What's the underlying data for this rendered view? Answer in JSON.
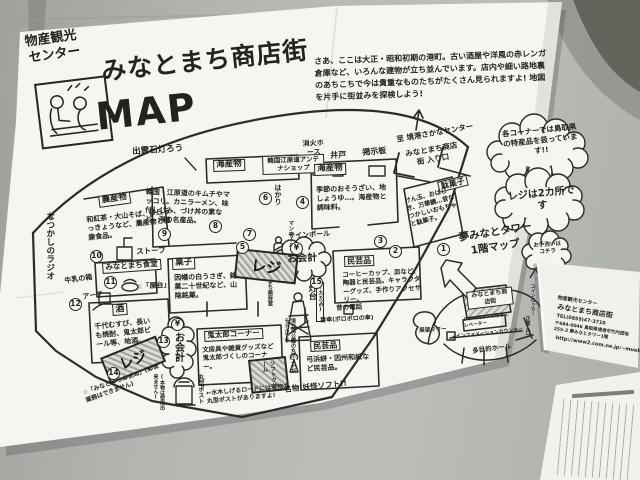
{
  "poster": {
    "header": {
      "org1": "物産観光",
      "org2": "センター",
      "title": "みなとまち商店街",
      "map_word": "MAP",
      "intro": "さあ、ここは大正・昭和初期の港町。古い酒屋や洋風の赤レンガ倉庫など、いろんな建物が立ち並んでいます。店内や細い路地裏のあちこちで今は貴重なものたちがたくさん見られますよ! 地図を片手に街並みを探検しよう!"
    },
    "bubbles": {
      "specialty": "各コーナーでは鳥取県の特産品を扱っています!!",
      "registers": "レジは2カ所です",
      "checkout": "お会計",
      "yen": "¥",
      "toilet": "お手洗いはコチラ"
    },
    "register_label": "レジ",
    "numbers": {
      "n1": "1",
      "n2": "2",
      "n3": "3",
      "n4": "4",
      "n5": "5",
      "n6": "6",
      "n7": "7",
      "n8": "8",
      "n9": "9",
      "n10": "10",
      "n11": "11",
      "n12": "12",
      "n13": "13",
      "n14": "14",
      "n15": "15"
    },
    "labels": {
      "izumo_lantern": "出雲石灯ろう",
      "fire_hose": "消火ホース",
      "well": "井戸",
      "notice_board": "掲示板",
      "to_fish_center": "至 境港さかなセンター",
      "entrance": "みなとまち商店街 入り口",
      "scale": "はかり",
      "manhole": "マンホール",
      "seafood1": "海産物",
      "korea_shop": "韓国江原道アンテナショップ",
      "korea_desc": "韓国・江原道のキムチやマッコリ。カニラーメン、味付しじみ、づけ丼の素など、海の名産品。",
      "seafood2": "海産物",
      "seafood2_desc": "季節のおそうざい、地しょうゆ…。海産物と調味料。",
      "dagashi": "駄菓子",
      "dagashi_desc": "けん玉、おはじき、万華鏡…昔なつかしいおもちゃと駄菓子。",
      "mingei1": "民芸品",
      "mingei1_desc": "コーヒーカップ、皿など、陶器と民芸品。キャラクターグッズ、手作りアクセサリー。",
      "kashi": "菓子",
      "kashi_desc": "因幡の白うさぎ、銘菓二十世紀など、山陰銘菓。",
      "nosan": "農産物",
      "nosan_desc": "和紅茶・大山そば、砂丘らっきょうなど、農産物と健康食品。",
      "radio": "なつかしのラジオ",
      "stove": "ストーブ",
      "shokudo": "みなとまち食堂",
      "yatai": "☆「屋台」",
      "milk_box": "牛乳の箱",
      "arch": "アーチ",
      "sake": "酒",
      "sake_desc": "千代むすび、長いも焼酎、鬼太郎ビール等、地酒。",
      "kitaro": "鬼太郎コーナー",
      "kitaro_desc": "文房具や雑貨グッズなど鬼太郎づくしのコーナー。",
      "softcream": "ソフトクリーム",
      "meibutsu": "名物!妖怪ソフト!!",
      "round_post": "丸型ポスト",
      "post_note": "(本物は使用出来ません)",
      "post_model": "境台場公園の丸ポストがモデルです",
      "mizuki_note": "←水木しげるロードには現物の丸型ポストがありますよ!",
      "post_office": "☆「みなとまち郵便局」(郵便業務はできません)",
      "mingei2": "民芸品",
      "mingei2_desc": "弓浜絣・因州和紙など民芸品。",
      "tatami": "(たたみ)",
      "old_phone": "昔の電話",
      "bangasa": "番傘(ボロボロの傘)",
      "lighthouse": "灯台",
      "sign_pole": "サインポール",
      "beauty_shop": "みなとまち美容室"
    },
    "tower": {
      "heading1": "夢みなとタワー",
      "heading2": "1階マップ",
      "tenbo": "展望タワー",
      "shotengai": "みなとまち商店街",
      "elevator": "タワーズカフェ行きエレベーター",
      "info": "←インフォメーションカウンター",
      "hall": "多目的ホール",
      "front_gate": "正面入口",
      "locker": "コインロッカー"
    },
    "contact": {
      "line1": "物産観光センター",
      "line2": "みなとまち商店街",
      "line3": "TEL(0859)47-3710",
      "line4": "〒684-0046 鳥取県境港市竹内団地255-3 夢みなとタワー1階",
      "line5": "http://www2.com.ne.jp/~mueb-s"
    }
  }
}
